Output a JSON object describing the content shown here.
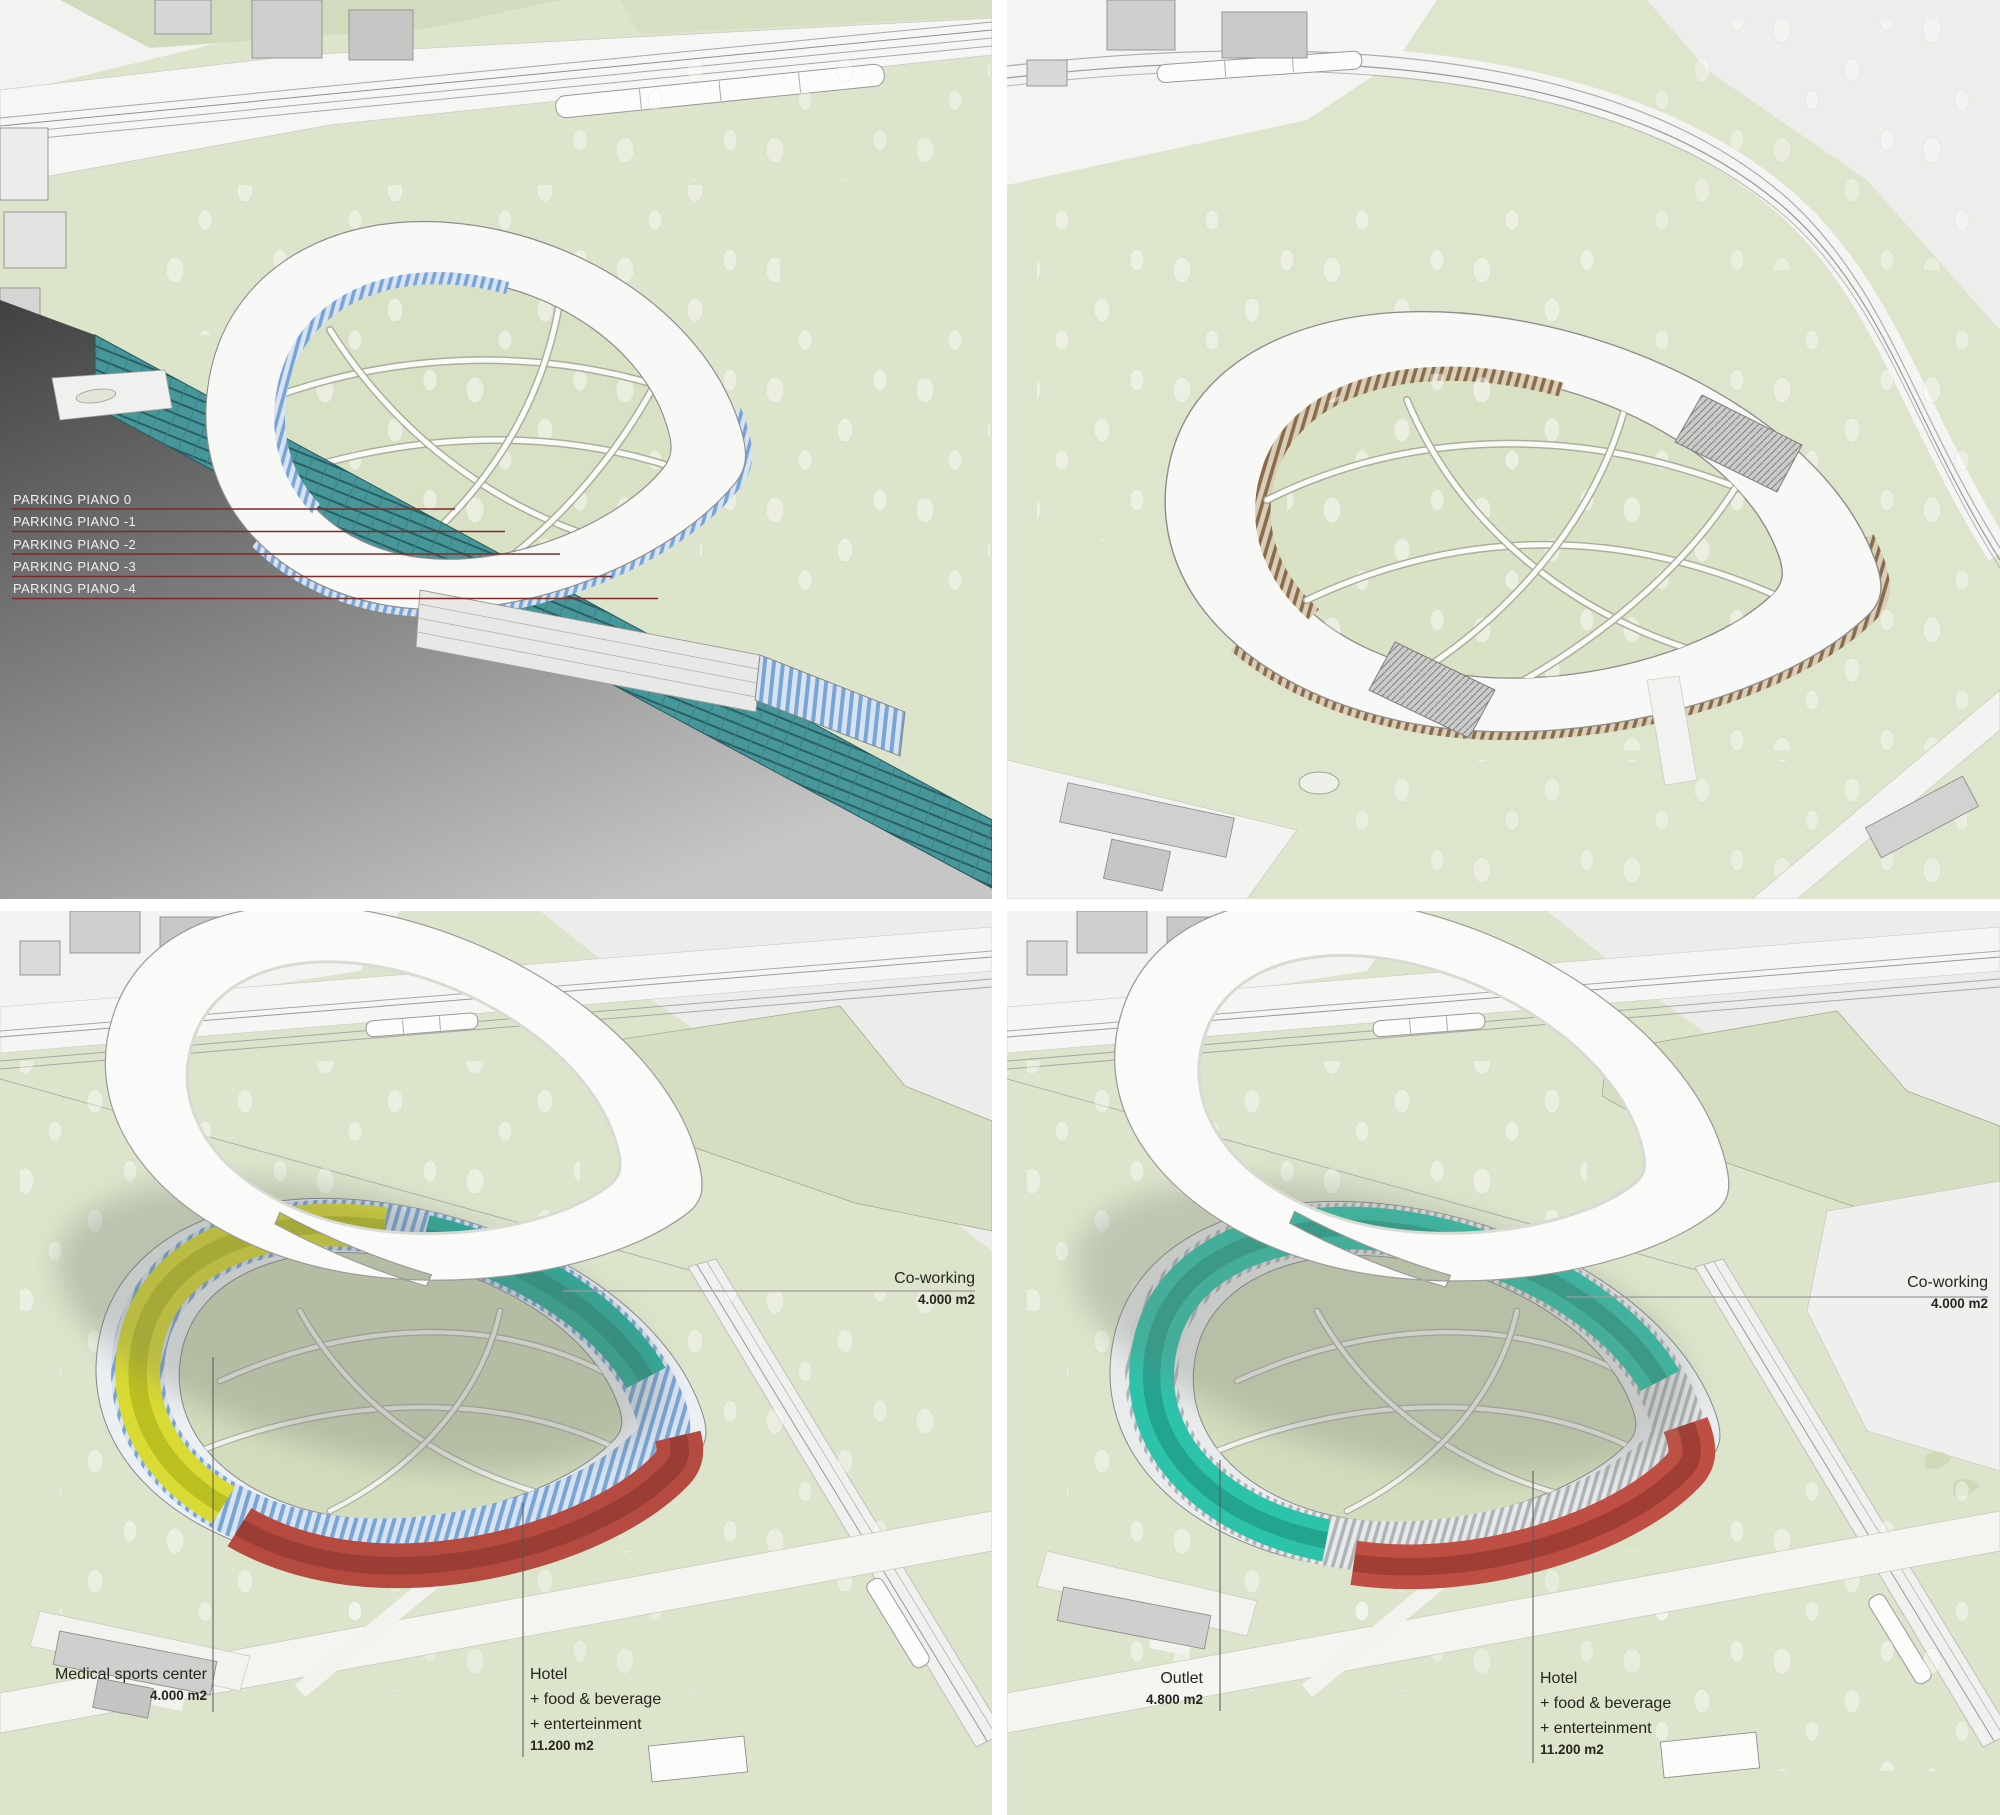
{
  "colors": {
    "site_green": "#dce4cb",
    "roof_white": "#f8f9f6",
    "glass_blue_facade": "#79a5d6",
    "wood_facade": "#8a6c4c",
    "parking_teal": "#44969a",
    "coworking_teal": "#2bb4a0",
    "coworking_teal_bright": "#2dc3ab",
    "hotel_red": "#b54a41",
    "medical_yellow": "#d9da33",
    "section_cut_gray": "#454545",
    "parking_leader_red": "#7b2b27"
  },
  "panels": {
    "parking_section": {
      "position": "top-left",
      "parking_levels": [
        "PARKING PIANO 0",
        "PARKING PIANO -1",
        "PARKING PIANO -2",
        "PARKING PIANO -3",
        "PARKING PIANO -4"
      ]
    },
    "site_overview": {
      "position": "top-right"
    },
    "program_option_1": {
      "position": "bottom-left",
      "coworking": {
        "title": "Co-working",
        "area": "4.000 m2"
      },
      "medical": {
        "title": "Medical sports center",
        "area": "4.000 m2"
      },
      "hotel": {
        "title": "Hotel",
        "line2": "+ food & beverage",
        "line3": "+ enterteinment",
        "area": "11.200 m2"
      }
    },
    "program_option_2": {
      "position": "bottom-right",
      "coworking": {
        "title": "Co-working",
        "area": "4.000 m2"
      },
      "outlet": {
        "title": "Outlet",
        "area": "4.800 m2"
      },
      "hotel": {
        "title": "Hotel",
        "line2": "+ food & beverage",
        "line3": "+ enterteinment",
        "area": "11.200 m2"
      }
    }
  }
}
